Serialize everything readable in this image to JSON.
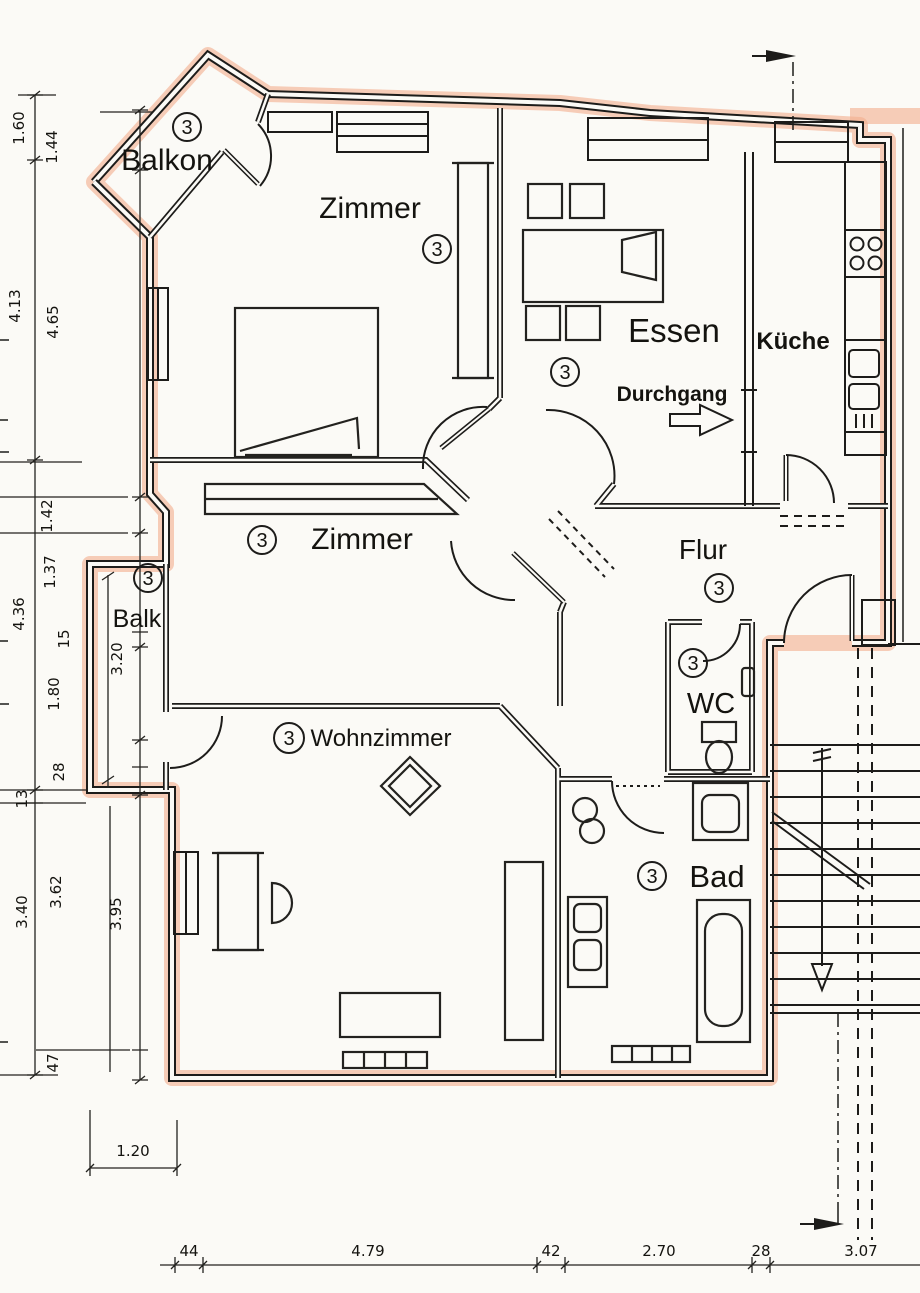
{
  "document_type": "floor-plan",
  "unit": {
    "badge": "3"
  },
  "colors": {
    "highlight": "#f3ad8e",
    "ink": "#1d1c1a",
    "paper": "#fbfaf6"
  },
  "rooms": {
    "balkon": {
      "label": "Balkon",
      "badge": "3"
    },
    "zimmer_top": {
      "label": "Zimmer",
      "badge": "3"
    },
    "essen": {
      "label": "Essen",
      "badge": "3"
    },
    "kueche": {
      "label": "Küche"
    },
    "zimmer_mid": {
      "label": "Zimmer",
      "badge": "3"
    },
    "balk": {
      "label": "Balk",
      "badge": "3"
    },
    "flur": {
      "label": "Flur",
      "badge": "3"
    },
    "wc": {
      "label": "WC",
      "badge": "3"
    },
    "wohnzimmer": {
      "label": "Wohnzimmer",
      "badge": "3"
    },
    "bad": {
      "label": "Bad",
      "badge": "3"
    }
  },
  "annotations": {
    "durchgang": "Durchgang"
  },
  "dims": {
    "v160": "1.60",
    "v144": "1.44",
    "v413": "4.13",
    "v465": "4.65",
    "v142": "1.42",
    "v137": "1.37",
    "v436": "4.36",
    "v15": "15",
    "v180": "1.80",
    "v28a": "28",
    "v13": "13",
    "v362": "3.62",
    "v340": "3.40",
    "v320": "3.20",
    "v395": "3.95",
    "v47": "47",
    "h120": "1.20",
    "h44": "44",
    "h479": "4.79",
    "h42": "42",
    "h270": "2.70",
    "h28b": "28",
    "h307": "3.07"
  }
}
